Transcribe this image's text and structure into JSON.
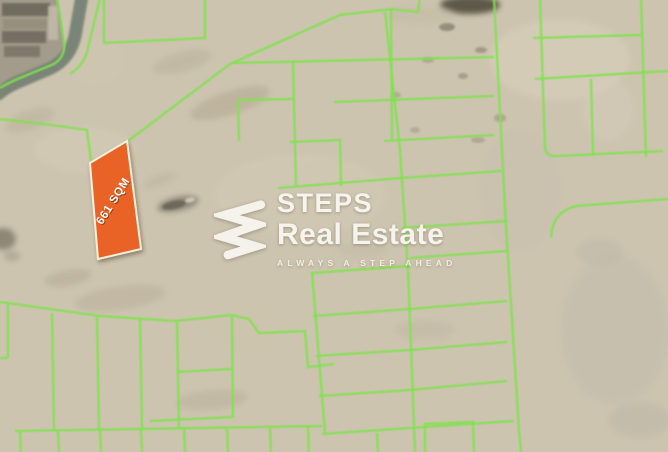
{
  "brand": {
    "name_line1": "STEPS",
    "name_line2": "Real Estate",
    "tagline": "ALWAYS A STEP AHEAD"
  },
  "plot": {
    "label": "661 SQM"
  },
  "colors": {
    "sand": "#cdc4af",
    "plot_line": "#7ee24e",
    "highlight": "#e96325",
    "highlight_border": "#f4eeda",
    "label_text": "#ffffff",
    "label_shadow": "rgba(61,31,8,0.5)",
    "road": "#7a8577",
    "compound": "#a39c8c",
    "watermark": "#faf8f2"
  },
  "map": {
    "plot_polygon": "90,163 127,141 141,249 98,259",
    "label_pos": {
      "x": 116,
      "y": 203,
      "angle": -58
    },
    "road_path": "M 82,-4 L 75,36 Q 70,58 51,68 L 18,82 Q 4,88 -4,96",
    "compound_polygon": "0,-2 58,-2 65,46 54,63 18,77 0,84",
    "buildings": [
      {
        "x": 2,
        "y": 3,
        "w": 48,
        "h": 13,
        "f": "#6b665a"
      },
      {
        "x": 3,
        "y": 19,
        "w": 44,
        "h": 10,
        "f": "#958e7d"
      },
      {
        "x": 2,
        "y": 31,
        "w": 44,
        "h": 12,
        "f": "#716b5e"
      },
      {
        "x": 4,
        "y": 46,
        "w": 36,
        "h": 11,
        "f": "#7b7567"
      },
      {
        "x": 48,
        "y": 6,
        "w": 10,
        "h": 34,
        "f": "#c2baa9"
      }
    ],
    "green_lines": [
      "M 100,-2 L 87,52 Q 83,66 70,74",
      "M 57,-2 L 64,42 Q 66,56 54,64 L 20,78 Q 8,83 0,88",
      "M 0,119 L 52,125 L 87,130 L 91,161",
      "M 104,-2 L 104,43 L 205,38 L 205,-2",
      "M 128,141 L 230,64 L 340,15 L 392,9 L 418,12 L 420,-2",
      "M 391,9 L 392,140",
      "M 234,63 L 494,57",
      "M 293,62 L 296,185",
      "M 239,141 L 238,100 L 293,99",
      "M 290,142 L 340,140 L 341,186",
      "M 278,188 L 402,178 L 502,171",
      "M 385,12 L 400,150 L 408,270 L 415,452",
      "M 334,102 L 494,96",
      "M 384,141 L 494,135",
      "M 494,-2 L 506,226 L 519,430 L 521,452",
      "M 402,228 L 507,221",
      "M 312,272 L 325,433",
      "M 312,273 L 410,266",
      "M 410,258 L 507,251",
      "M 313,316 L 410,309 L 507,301",
      "M 316,356 L 410,350 L 507,342",
      "M 319,396 L 410,390 L 507,381",
      "M 322,434 L 410,428 L 514,421",
      "M 377,433 L 378,452",
      "M 425,452 L 425,424 L 473,422 L 474,452",
      "M 0,302 L 100,316 L 175,321 L 232,315",
      "M 232,315 L 249,319 L 259,333 L 305,331 L 308,367 L 334,364",
      "M 8,303 L 8,358 M 0,358 L 8,358",
      "M 52,313 L 54,430",
      "M 97,317 L 99,430",
      "M 140,319 L 142,429",
      "M 177,322 L 179,428",
      "M 232,316 L 233,418",
      "M 177,372 L 232,369",
      "M 150,421 L 232,417",
      "M 15,431 L 322,426",
      "M 20,432 L 21,452 M 58,431 L 59,452 M 100,430 L 101,452 M 141,430 L 142,452 M 184,429 L 185,452 M 227,429 L 228,452 M 270,428 L 271,452 M 308,427 L 309,452",
      "M 540,-2 L 545,148 Q 546,157 557,156 L 663,151",
      "M 641,-2 L 646,157",
      "M 533,38 L 641,35",
      "M 535,79 L 668,71",
      "M 591,79 L 593,155",
      "M 551,238 Q 552,212 576,206 L 668,199"
    ],
    "blotches": [
      {
        "cx": 470,
        "cy": 5,
        "rx": 30,
        "ry": 9,
        "f": "#514e3c",
        "o": 0.9
      },
      {
        "cx": 447,
        "cy": 27,
        "rx": 8,
        "ry": 4,
        "f": "#5d5948",
        "o": 0.5
      },
      {
        "cx": 481,
        "cy": 50,
        "rx": 6,
        "ry": 3,
        "f": "#5d5948",
        "o": 0.4
      },
      {
        "cx": 463,
        "cy": 76,
        "rx": 5,
        "ry": 3,
        "f": "#5d5948",
        "o": 0.35
      },
      {
        "cx": 428,
        "cy": 60,
        "rx": 6,
        "ry": 3,
        "f": "#6a6452",
        "o": 0.3
      },
      {
        "cx": 500,
        "cy": 118,
        "rx": 6,
        "ry": 4,
        "f": "#6a6452",
        "o": 0.3
      },
      {
        "cx": 478,
        "cy": 140,
        "rx": 7,
        "ry": 3,
        "f": "#6a6452",
        "o": 0.3
      },
      {
        "cx": 396,
        "cy": 95,
        "rx": 5,
        "ry": 3,
        "f": "#6a6452",
        "o": 0.25
      },
      {
        "cx": 415,
        "cy": 130,
        "rx": 5,
        "ry": 3,
        "f": "#6a6452",
        "o": 0.25
      },
      {
        "cx": 560,
        "cy": 60,
        "rx": 70,
        "ry": 40,
        "f": "#d9d1bd",
        "o": 0.55
      },
      {
        "cx": 615,
        "cy": 330,
        "rx": 55,
        "ry": 75,
        "f": "#c2bcae",
        "o": 0.5
      },
      {
        "cx": 300,
        "cy": 195,
        "rx": 85,
        "ry": 40,
        "f": "#d6cdb9",
        "o": 0.4
      },
      {
        "cx": 85,
        "cy": 150,
        "rx": 50,
        "ry": 22,
        "f": "#d7cfbb",
        "o": 0.4
      },
      {
        "cx": 230,
        "cy": 103,
        "rx": 42,
        "ry": 12,
        "f": "#b1a68f",
        "o": 0.5,
        "rot": -18
      },
      {
        "cx": 182,
        "cy": 62,
        "rx": 30,
        "ry": 10,
        "f": "#b4aa94",
        "o": 0.4,
        "rot": -15
      },
      {
        "cx": 120,
        "cy": 298,
        "rx": 46,
        "ry": 12,
        "f": "#b5ab97",
        "o": 0.45,
        "rot": -8
      },
      {
        "cx": 68,
        "cy": 278,
        "rx": 24,
        "ry": 8,
        "f": "#aaa08c",
        "o": 0.4,
        "rot": -10
      },
      {
        "cx": 212,
        "cy": 400,
        "rx": 36,
        "ry": 10,
        "f": "#b3a995",
        "o": 0.4,
        "rot": -5
      },
      {
        "cx": 425,
        "cy": 330,
        "rx": 30,
        "ry": 10,
        "f": "#bdb4a2",
        "o": 0.4
      },
      {
        "cx": 600,
        "cy": 252,
        "rx": 24,
        "ry": 14,
        "f": "#bdb7a8",
        "o": 0.45
      },
      {
        "cx": 640,
        "cy": 420,
        "rx": 32,
        "ry": 18,
        "f": "#b8b2a3",
        "o": 0.4
      },
      {
        "cx": 362,
        "cy": 250,
        "rx": 26,
        "ry": 8,
        "f": "#c0b7a4",
        "o": 0.4
      },
      {
        "cx": 30,
        "cy": 120,
        "rx": 26,
        "ry": 10,
        "f": "#b9b09b",
        "o": 0.5,
        "rot": -20
      },
      {
        "cx": 3,
        "cy": 239,
        "rx": 13,
        "ry": 11,
        "f": "#6e6859",
        "o": 0.65
      },
      {
        "cx": 12,
        "cy": 256,
        "rx": 8,
        "ry": 5,
        "f": "#8a8271",
        "o": 0.4
      },
      {
        "cx": 520,
        "cy": 190,
        "rx": 40,
        "ry": 60,
        "f": "#c7bfae",
        "o": 0.45
      },
      {
        "cx": 95,
        "cy": 60,
        "rx": 30,
        "ry": 25,
        "f": "#cfc6b1",
        "o": 0.5
      },
      {
        "cx": 420,
        "cy": 15,
        "rx": 35,
        "ry": 10,
        "f": "#c3b9a2",
        "o": 0.45
      },
      {
        "cx": 250,
        "cy": 330,
        "rx": 40,
        "ry": 25,
        "f": "#cdc4ae",
        "o": 0.45
      },
      {
        "cx": 160,
        "cy": 180,
        "rx": 18,
        "ry": 6,
        "f": "#b7ad99",
        "o": 0.4,
        "rot": -20
      },
      {
        "cx": 608,
        "cy": 110,
        "rx": 26,
        "ry": 30,
        "f": "#d4ccb9",
        "o": 0.5
      },
      {
        "cx": 178,
        "cy": 204,
        "rx": 21,
        "ry": 7,
        "f": "#7d776a",
        "o": 0.78,
        "rot": -12
      },
      {
        "cx": 174,
        "cy": 205,
        "rx": 12,
        "ry": 4,
        "f": "#5f5a4f",
        "o": 0.7,
        "rot": -12
      },
      {
        "cx": 190,
        "cy": 200,
        "rx": 5,
        "ry": 2.5,
        "f": "#d8d2c2",
        "o": 0.85,
        "rot": -12
      }
    ]
  }
}
